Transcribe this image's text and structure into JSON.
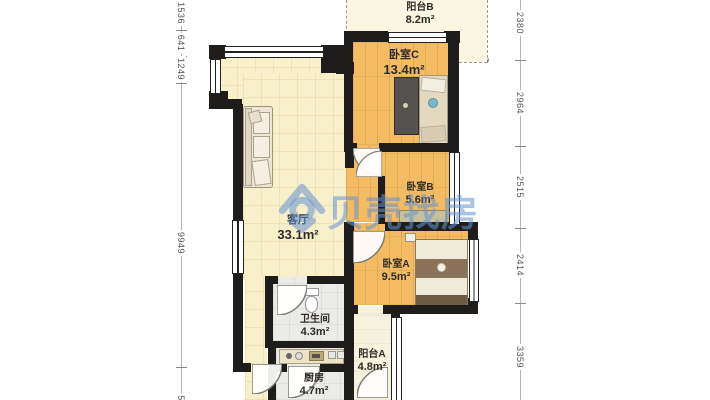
{
  "watermark": {
    "brand_text": "贝壳找房",
    "logo": "beike-shell-icon",
    "color": "#6494D4"
  },
  "rooms": {
    "living": {
      "name": "客厅",
      "area": "33.1m²"
    },
    "bedroom_c": {
      "name": "卧室C",
      "area": "13.4m²"
    },
    "bedroom_b": {
      "name": "卧室B",
      "area": "5.6m²"
    },
    "bedroom_a": {
      "name": "卧室A",
      "area": "9.5m²"
    },
    "bathroom": {
      "name": "卫生间",
      "area": "4.3m²"
    },
    "kitchen": {
      "name": "厨房",
      "area": "4.7m²"
    },
    "balcony_a": {
      "name": "阳台A",
      "area": "4.8m²"
    },
    "balcony_b": {
      "name": "阳台B",
      "area": "8.2m²"
    }
  },
  "dimensions": {
    "left": [
      "1536",
      "641",
      "1249",
      "9949",
      "5"
    ],
    "right": [
      "2380",
      "2964",
      "2515",
      "2414",
      "3359"
    ]
  },
  "icons": {
    "extent_arrow": "↘"
  },
  "colors": {
    "wall": "#1E1D1B",
    "wood_floor": "#F2BB64",
    "living_floor": "#F8EFCB",
    "tile_floor": "#EBEBE7",
    "balcony_floor": "#F6F2DC",
    "watermark_blue": "#6494D4"
  }
}
